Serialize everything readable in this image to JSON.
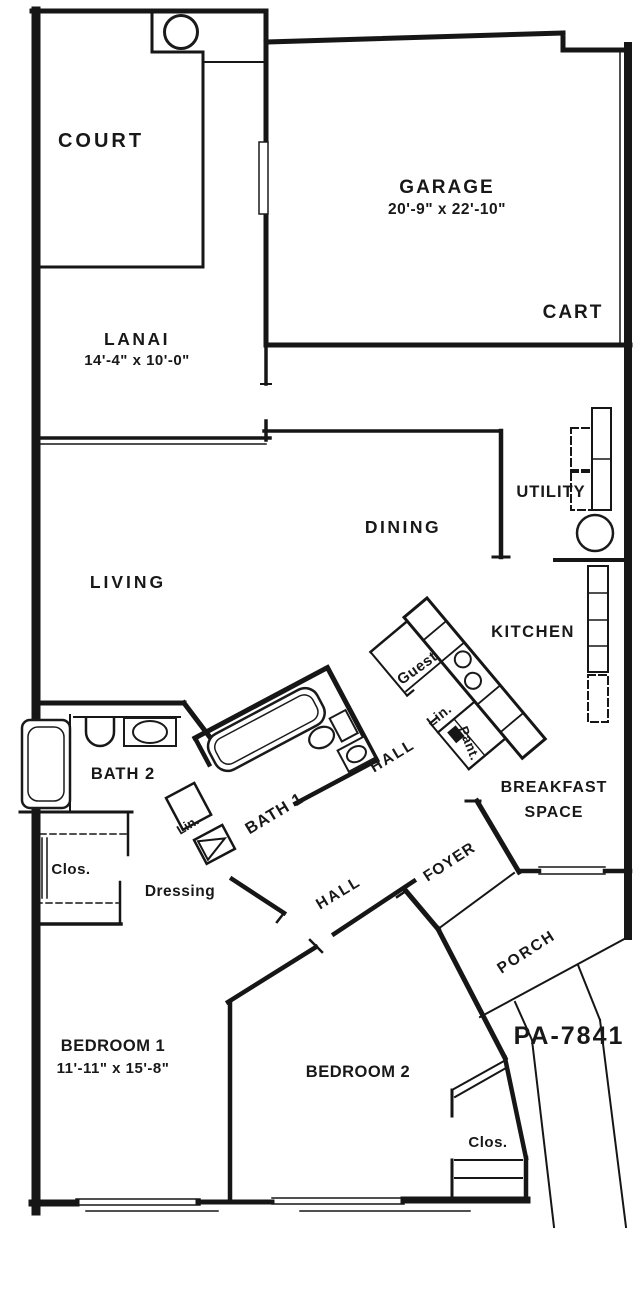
{
  "plan": {
    "stamp": "PA-7841",
    "colors": {
      "ink": "#161616",
      "stamp": "#8e8e8e",
      "background": "#ffffff"
    },
    "rooms": [
      {
        "name": "Court",
        "label": "COURT",
        "dims": ""
      },
      {
        "name": "Garage",
        "label": "GARAGE",
        "dims": "20'-9\" x 22'-10\""
      },
      {
        "name": "Cart",
        "label": "CART",
        "dims": ""
      },
      {
        "name": "Lanai",
        "label": "LANAI",
        "dims": "14'-4\" x 10'-0\""
      },
      {
        "name": "Utility",
        "label": "UTILITY",
        "dims": ""
      },
      {
        "name": "Dining",
        "label": "DINING",
        "dims": ""
      },
      {
        "name": "Living",
        "label": "LIVING",
        "dims": ""
      },
      {
        "name": "Kitchen",
        "label": "KITCHEN",
        "dims": ""
      },
      {
        "name": "Guest closet",
        "label": "Guest",
        "dims": ""
      },
      {
        "name": "Linen (kitchen)",
        "label": "Lin.",
        "dims": ""
      },
      {
        "name": "Pantry",
        "label": "Pant.",
        "dims": ""
      },
      {
        "name": "Hall (upper)",
        "label": "HALL",
        "dims": ""
      },
      {
        "name": "Bath 2",
        "label": "BATH 2",
        "dims": ""
      },
      {
        "name": "Bath 1",
        "label": "BATH 1",
        "dims": ""
      },
      {
        "name": "Linen (bath)",
        "label": "Lin.",
        "dims": ""
      },
      {
        "name": "Breakfast Space",
        "label": "BREAKFAST SPACE",
        "dims": ""
      },
      {
        "name": "Closet (bedroom 1)",
        "label": "Clos.",
        "dims": ""
      },
      {
        "name": "Dressing",
        "label": "Dressing",
        "dims": ""
      },
      {
        "name": "Foyer",
        "label": "FOYER",
        "dims": ""
      },
      {
        "name": "Hall (lower)",
        "label": "HALL",
        "dims": ""
      },
      {
        "name": "Porch",
        "label": "PORCH",
        "dims": ""
      },
      {
        "name": "Bedroom 1",
        "label": "BEDROOM 1",
        "dims": "11'-11\" x 15'-8\""
      },
      {
        "name": "Bedroom 2",
        "label": "BEDROOM 2",
        "dims": ""
      },
      {
        "name": "Closet (bedroom 2)",
        "label": "Clos.",
        "dims": ""
      }
    ],
    "labels": [
      {
        "id": "court",
        "text": "COURT",
        "x": 101,
        "y": 147,
        "size": 20,
        "ls": 3
      },
      {
        "id": "garage",
        "text": "GARAGE",
        "x": 447,
        "y": 193,
        "size": 19,
        "ls": 2
      },
      {
        "id": "garage-dims",
        "text": "20'-9\" x 22'-10\"",
        "x": 447,
        "y": 214,
        "size": 15.5,
        "ls": 0.5
      },
      {
        "id": "cart",
        "text": "CART",
        "x": 573,
        "y": 318,
        "size": 19,
        "ls": 2
      },
      {
        "id": "lanai",
        "text": "LANAI",
        "x": 137,
        "y": 345,
        "size": 17.5,
        "ls": 2.5
      },
      {
        "id": "lanai-dims",
        "text": "14'-4\" x 10'-0\"",
        "x": 137,
        "y": 365,
        "size": 15,
        "ls": 0.5
      },
      {
        "id": "utility",
        "text": "UTILITY",
        "x": 551,
        "y": 497,
        "size": 16.5,
        "ls": 1
      },
      {
        "id": "dining",
        "text": "DINING",
        "x": 403,
        "y": 533,
        "size": 17.5,
        "ls": 2.5
      },
      {
        "id": "living",
        "text": "LIVING",
        "x": 128,
        "y": 588,
        "size": 17.5,
        "ls": 3
      },
      {
        "id": "kitchen",
        "text": "KITCHEN",
        "x": 533,
        "y": 637,
        "size": 16.5,
        "ls": 1.5
      },
      {
        "id": "guest",
        "text": "Guest",
        "x": 420,
        "y": 672,
        "size": 15,
        "ls": 0.5,
        "rotate": -36
      },
      {
        "id": "lin-kitchen",
        "text": "Lin.",
        "x": 442,
        "y": 719,
        "size": 14,
        "ls": 0.5,
        "rotate": -38
      },
      {
        "id": "pant",
        "text": "Pant.",
        "x": 465,
        "y": 745,
        "size": 13.5,
        "ls": 0.5,
        "rotate": 68
      },
      {
        "id": "hall-upper",
        "text": "HALL",
        "x": 395,
        "y": 760,
        "size": 15.5,
        "ls": 2,
        "rotate": -31
      },
      {
        "id": "bath2",
        "text": "BATH 2",
        "x": 123,
        "y": 779,
        "size": 16.5,
        "ls": 1
      },
      {
        "id": "bath1",
        "text": "BATH 1",
        "x": 277,
        "y": 818,
        "size": 16.5,
        "ls": 1,
        "rotate": -31
      },
      {
        "id": "lin-bath",
        "text": "Lin.",
        "x": 190,
        "y": 829,
        "size": 13,
        "ls": 0,
        "rotate": -31
      },
      {
        "id": "breakfast-1",
        "text": "BREAKFAST",
        "x": 554,
        "y": 792,
        "size": 16,
        "ls": 1
      },
      {
        "id": "breakfast-2",
        "text": "SPACE",
        "x": 554,
        "y": 817,
        "size": 16,
        "ls": 1
      },
      {
        "id": "clos-left",
        "text": "Clos.",
        "x": 71,
        "y": 874,
        "size": 15,
        "ls": 0.5
      },
      {
        "id": "dressing",
        "text": "Dressing",
        "x": 180,
        "y": 896,
        "size": 15.5,
        "ls": 0.5
      },
      {
        "id": "foyer",
        "text": "FOYER",
        "x": 452,
        "y": 866,
        "size": 15.5,
        "ls": 1,
        "rotate": -33
      },
      {
        "id": "hall-lower",
        "text": "HALL",
        "x": 341,
        "y": 897,
        "size": 15.5,
        "ls": 2,
        "rotate": -31
      },
      {
        "id": "porch",
        "text": "PORCH",
        "x": 529,
        "y": 956,
        "size": 15.5,
        "ls": 2,
        "rotate": -33
      },
      {
        "id": "stamp",
        "text": "PA-7841",
        "x": 569,
        "y": 1044,
        "size": 25,
        "ls": 2,
        "color": "#8e8e8e"
      },
      {
        "id": "bedroom1",
        "text": "BEDROOM 1",
        "x": 113,
        "y": 1051,
        "size": 16.5,
        "ls": 0.5
      },
      {
        "id": "bedroom1-dims",
        "text": "11'-11\" x 15'-8\"",
        "x": 113,
        "y": 1073,
        "size": 15,
        "ls": 0.5
      },
      {
        "id": "bedroom2",
        "text": "BEDROOM 2",
        "x": 358,
        "y": 1077,
        "size": 16.5,
        "ls": 0.5
      },
      {
        "id": "clos-bed2",
        "text": "Clos.",
        "x": 488,
        "y": 1147,
        "size": 15,
        "ls": 0.5
      }
    ]
  }
}
